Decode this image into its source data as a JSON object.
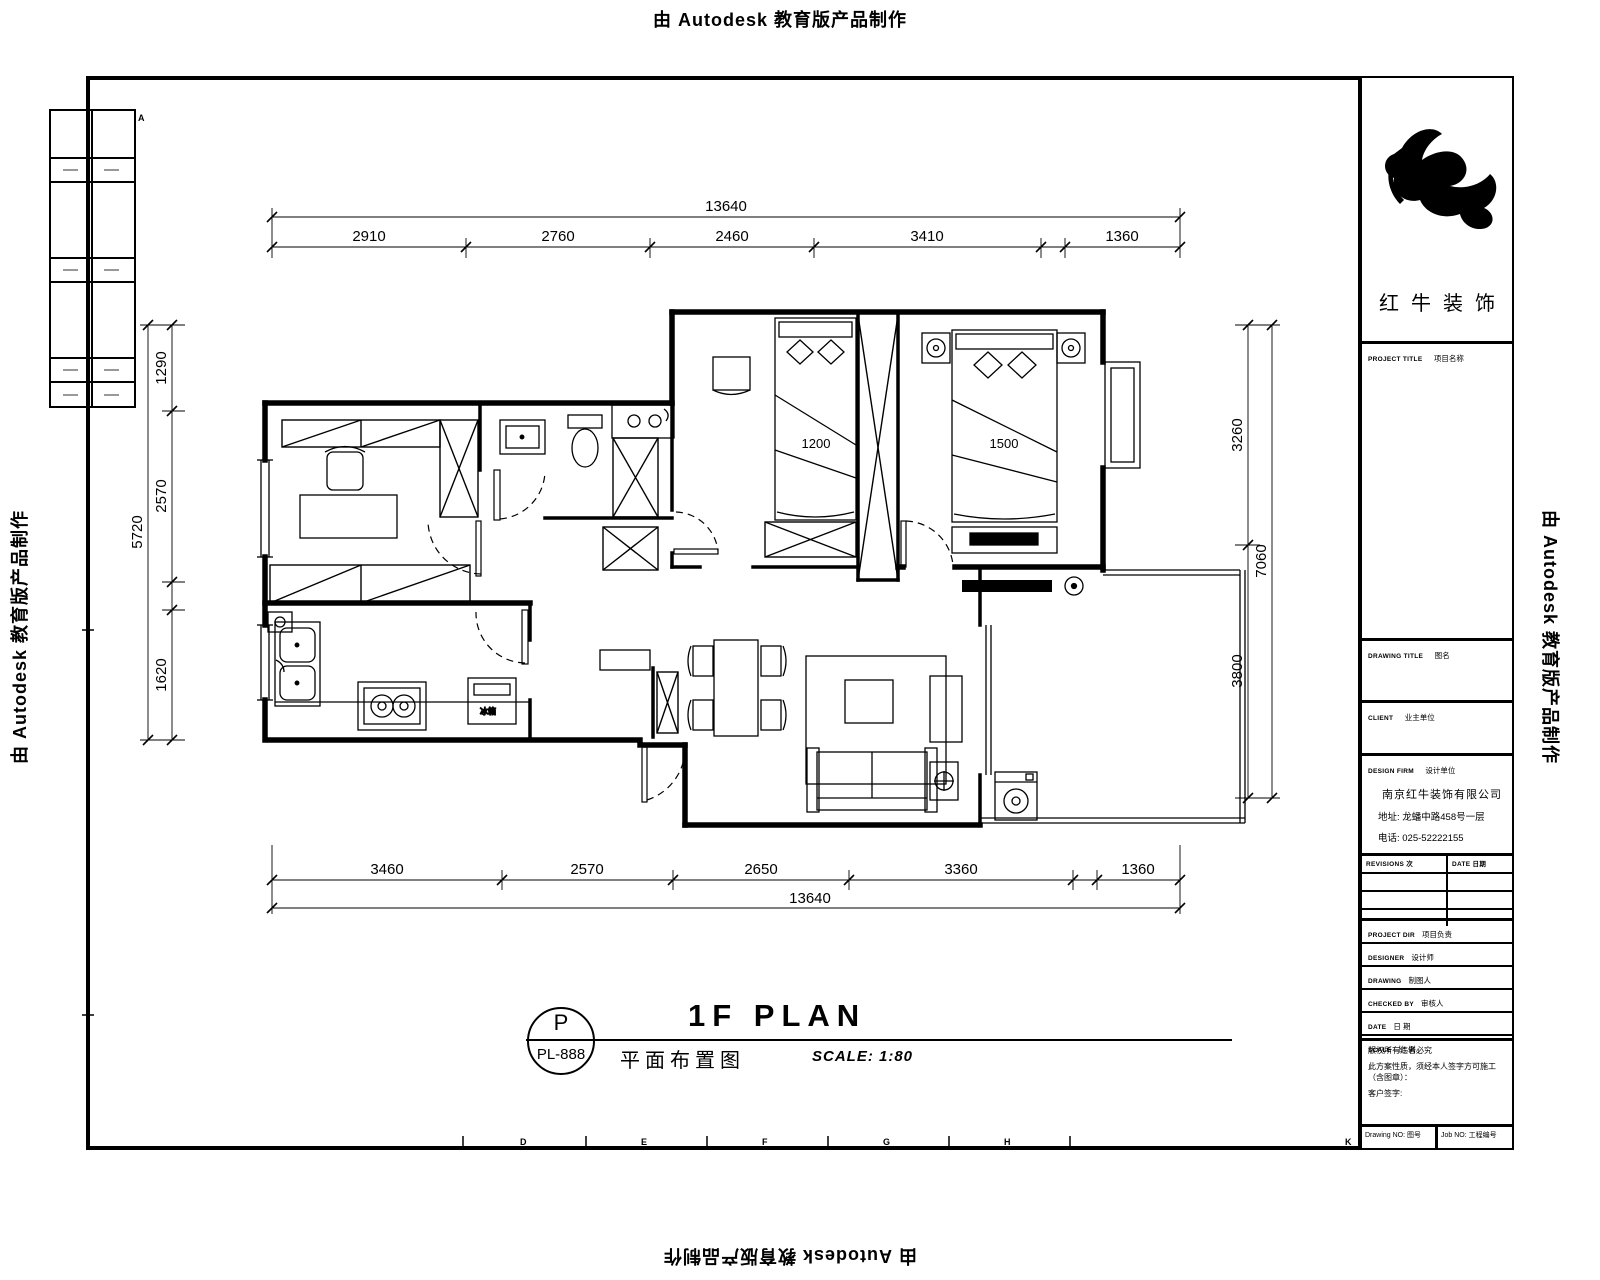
{
  "banner": {
    "text": "由 Autodesk 教育版产品制作"
  },
  "dims": {
    "top_total": "13640",
    "top_segs": [
      "2910",
      "2760",
      "2460",
      "3410",
      "1360"
    ],
    "bottom_segs": [
      "3460",
      "2570",
      "2650",
      "3360",
      "1360"
    ],
    "bottom_total": "13640",
    "left_total": "5720",
    "left_segs": [
      "1290",
      "2570",
      "1620"
    ],
    "right_segs": [
      "3260",
      "3800"
    ],
    "right_total": "7060",
    "bed1": "1200",
    "bed2": "1500"
  },
  "labels": {
    "fridge": "冰箱"
  },
  "grid_refs": {
    "corner": "A",
    "bottom": [
      "D",
      "E",
      "F",
      "G",
      "H",
      "K"
    ]
  },
  "plan_title": {
    "bubble_letter": "P",
    "bubble_code": "PL-888",
    "title": "1F PLAN",
    "subtitle": "平面布置图",
    "scale": "SCALE:  1:80"
  },
  "title_block": {
    "brand": "红牛装饰",
    "project_label": "PROJECT TITLE",
    "project_value": "项目名称",
    "drawing_label": "DRAWING TITLE",
    "drawing_value": "图名",
    "client_label": "CLIENT",
    "client_value": "业主单位",
    "firm_label": "DESIGN FIRM",
    "firm_value": "设计单位",
    "firm_name": "南京红牛装饰有限公司",
    "firm_address": "地址: 龙蟠中路458号一层",
    "firm_phone": "电话: 025-52222155",
    "revisions_label": "REVISIONS  次",
    "date_label": "DATE 日期",
    "rows": [
      {
        "label": "PROJECT DIR",
        "value": "项目负责"
      },
      {
        "label": "DESIGNER",
        "value": "设计师"
      },
      {
        "label": "DRAWING",
        "value": "制图人"
      },
      {
        "label": "CHECKED BY",
        "value": "审核人"
      },
      {
        "label": "DATE",
        "value": "日 期"
      },
      {
        "label": "SCALE",
        "value": "比 例"
      }
    ],
    "note1": "版权所有违者必究",
    "note2": "此方案性质，须经本人签字方可施工（含图章）：",
    "note3": "客户签字:",
    "drawing_no": "Drawing NO:  图号",
    "job_no": "Job NO:  工程编号"
  }
}
